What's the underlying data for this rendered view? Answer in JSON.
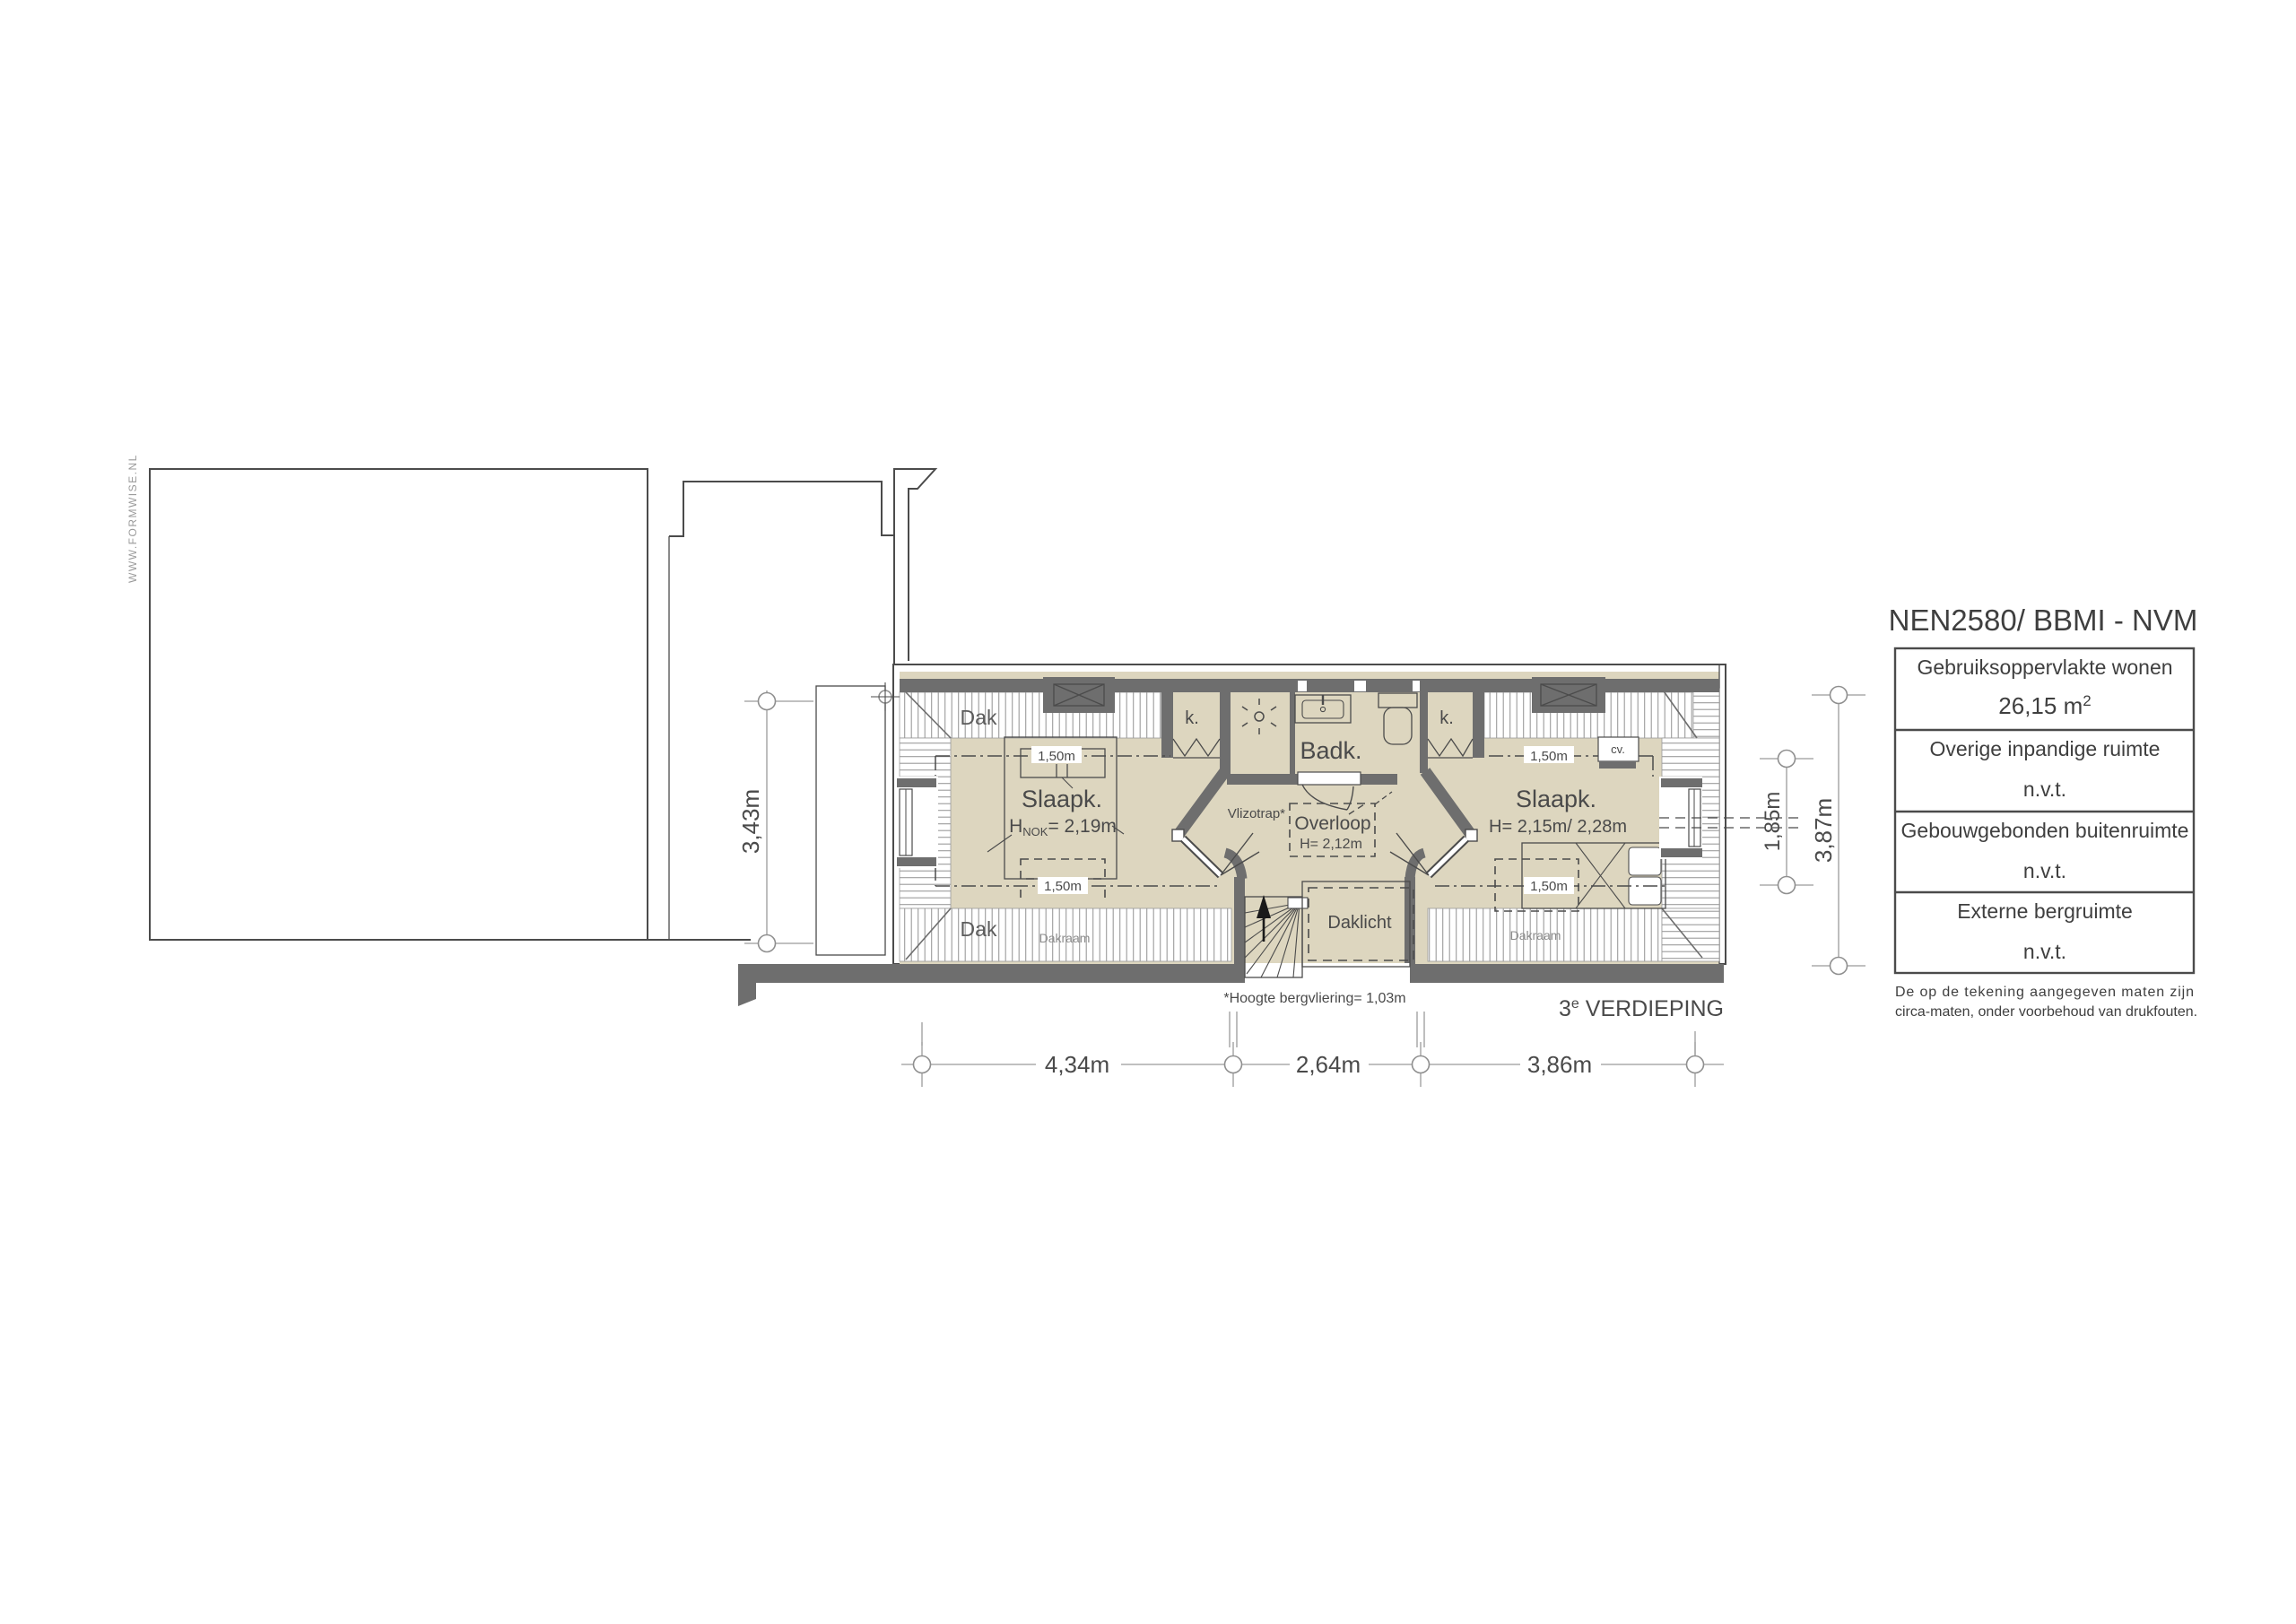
{
  "watermark": "WWW.FORMWISE.NL",
  "plan": {
    "floor_label": {
      "num": "3",
      "sup": "e",
      "rest": " VERDIEPING"
    },
    "footnote": "*Hoogte bergvliering= 1,03m",
    "rooms": {
      "bedroom_left": {
        "name": "Slaapk.",
        "height_h": "H",
        "height_sub": "NOK",
        "height_eq": "= 2,19m"
      },
      "bedroom_right": {
        "name": "Slaapk.",
        "height": "H= 2,15m/ 2,28m"
      },
      "bathroom": {
        "name": "Badk."
      },
      "landing": {
        "name": "Overloop",
        "height": "H= 2,12m"
      },
      "closet_left": "k.",
      "closet_right": "k.",
      "cv": "cv.",
      "vlizotrap": "Vlizotrap*",
      "daklicht": "Daklicht",
      "dak_top": "Dak",
      "dak_bottom": "Dak",
      "dakraam_left": "Dakraam",
      "dakraam_right": "Dakraam"
    },
    "contours": {
      "left_top": "1,50m",
      "left_bottom": "1,50m",
      "right_top": "1,50m",
      "right_bottom": "1,50m"
    },
    "dims": {
      "bottom_1": "4,34m",
      "bottom_2": "2,64m",
      "bottom_3": "3,86m",
      "left": "3,43m",
      "right_inner": "1,85m",
      "right_outer": "3,87m"
    }
  },
  "nen_table": {
    "title": "NEN2580/ BBMI - NVM",
    "rows": [
      {
        "label": "Gebruiksoppervlakte wonen",
        "value": "26,15 m",
        "value_sup": "2"
      },
      {
        "label": "Overige inpandige ruimte",
        "value": "n.v.t.",
        "value_sup": ""
      },
      {
        "label": "Gebouwgebonden buitenruimte",
        "value": "n.v.t.",
        "value_sup": ""
      },
      {
        "label": "Externe bergruimte",
        "value": "n.v.t.",
        "value_sup": ""
      }
    ],
    "footnote1": "De op de tekening aangegeven maten zijn",
    "footnote2": "circa-maten, onder voorbehoud van drukfouten."
  }
}
